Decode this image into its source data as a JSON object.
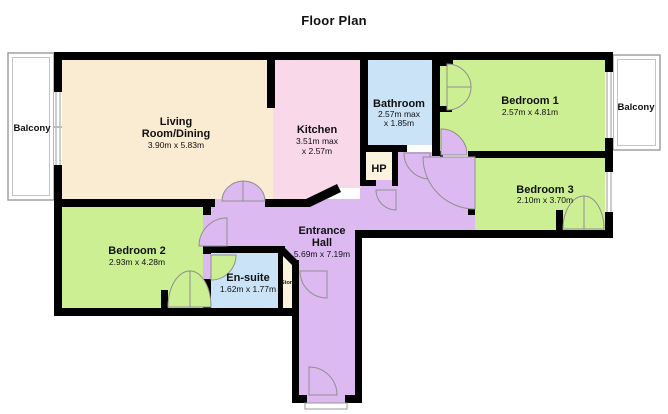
{
  "title": "Floor Plan",
  "rooms": {
    "living": {
      "line1": "Living",
      "line2": "Room/Dining",
      "dims": "3.90m x 5.83m",
      "color": "#FAEBD3"
    },
    "kitchen": {
      "name": "Kitchen",
      "dims1": "3.51m max",
      "dims2": "x 2.57m",
      "color": "#F9D8E9"
    },
    "bathroom": {
      "name": "Bathroom",
      "dims1": "2.57m max",
      "dims2": "x 1.85m",
      "color": "#CBE3F7"
    },
    "bedroom1": {
      "name": "Bedroom 1",
      "dims": "2.57m x 4.81m",
      "color": "#CDEF93"
    },
    "bedroom2": {
      "name": "Bedroom 2",
      "dims": "2.93m x 4.28m",
      "color": "#CDEF93"
    },
    "bedroom3": {
      "name": "Bedroom 3",
      "dims": "2.10m x 3.70m",
      "color": "#CDEF93"
    },
    "ensuite": {
      "name": "En-suite",
      "dims": "1.62m x 1.77m",
      "color": "#CBE3F7"
    },
    "hall": {
      "line1": "Entrance",
      "line2": "Hall",
      "dims": "5.69m x 7.19m",
      "color": "#DDB9F1"
    },
    "hp": {
      "name": "HP",
      "color": "#FCF3DE"
    },
    "store": {
      "name": "Store",
      "color": "#FCF3DE"
    },
    "balcony_left": {
      "name": "Balcony",
      "color": "#FFFFFF"
    },
    "balcony_right": {
      "name": "Balcony",
      "color": "#FFFFFF"
    }
  },
  "wall_color": "#000000",
  "door_arc_color": "#8F8F8F"
}
